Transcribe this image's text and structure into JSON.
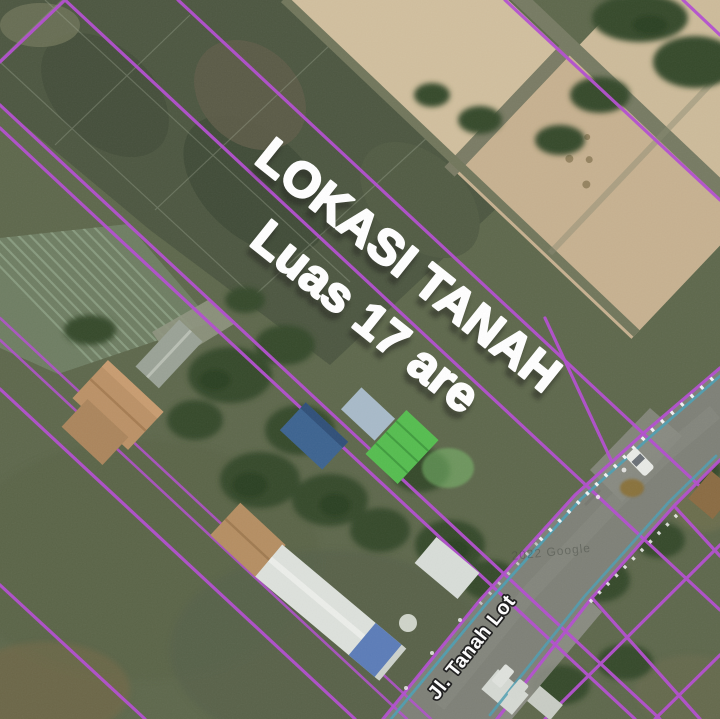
{
  "map": {
    "title": "Satellite map of land for sale with parcel overlay",
    "annotation": {
      "line1": "LOKASI TANAH",
      "line2": "Luas 17 are"
    },
    "road_label": "Jl. Tanah Lot",
    "watermark": "2022 Google",
    "colors": {
      "parcel_line": "#b44fd0",
      "road_line": "#4d9eb2",
      "annotation_text": "#ffffff",
      "annotation_shadow": "#20241f",
      "road_label_text": "#ffffff",
      "road_label_outline": "#1c1c1c",
      "road_surface": "#7e8077",
      "field_green": "#5e684c",
      "paddy_tan": "#cfbd9c"
    }
  }
}
